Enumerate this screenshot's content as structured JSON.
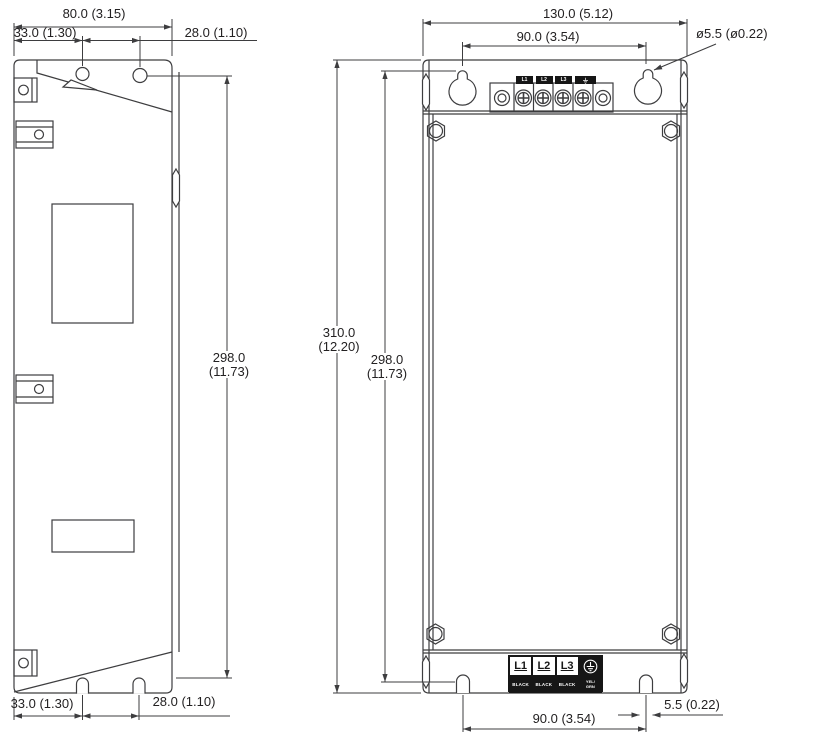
{
  "dimensions": {
    "side_width": "80.0 (3.15)",
    "side_hole_offset": "33.0 (1.30)",
    "side_hole_pitch": "28.0 (1.10)",
    "side_mount_height": [
      "298.0",
      "(11.73)"
    ],
    "front_width": "130.0 (5.12)",
    "front_hole_pitch_top": "90.0 (3.54)",
    "hole_diameter": "ø5.5 (ø0.22)",
    "front_total_height": [
      "310.0",
      "(12.20)"
    ],
    "front_mount_height": [
      "298.0",
      "(11.73)"
    ],
    "side_bottom_offset": "33.0 (1.30)",
    "side_bottom_pitch": "28.0 (1.10)",
    "front_hole_pitch_bottom": "90.0 (3.54)",
    "bottom_slot_width": "5.5 (0.22)"
  },
  "top_terminal_block": {
    "labels": [
      "L1",
      "L2",
      "L3"
    ]
  },
  "bottom_terminal_block": {
    "terminals": [
      "L1",
      "L2",
      "L3"
    ],
    "wire_colors": [
      "BLACK",
      "BLACK",
      "BLACK"
    ],
    "ground_wire_color": [
      "YEL/",
      "GRN"
    ]
  },
  "colors": {
    "line": "#3d3d3f",
    "text": "#232122"
  }
}
